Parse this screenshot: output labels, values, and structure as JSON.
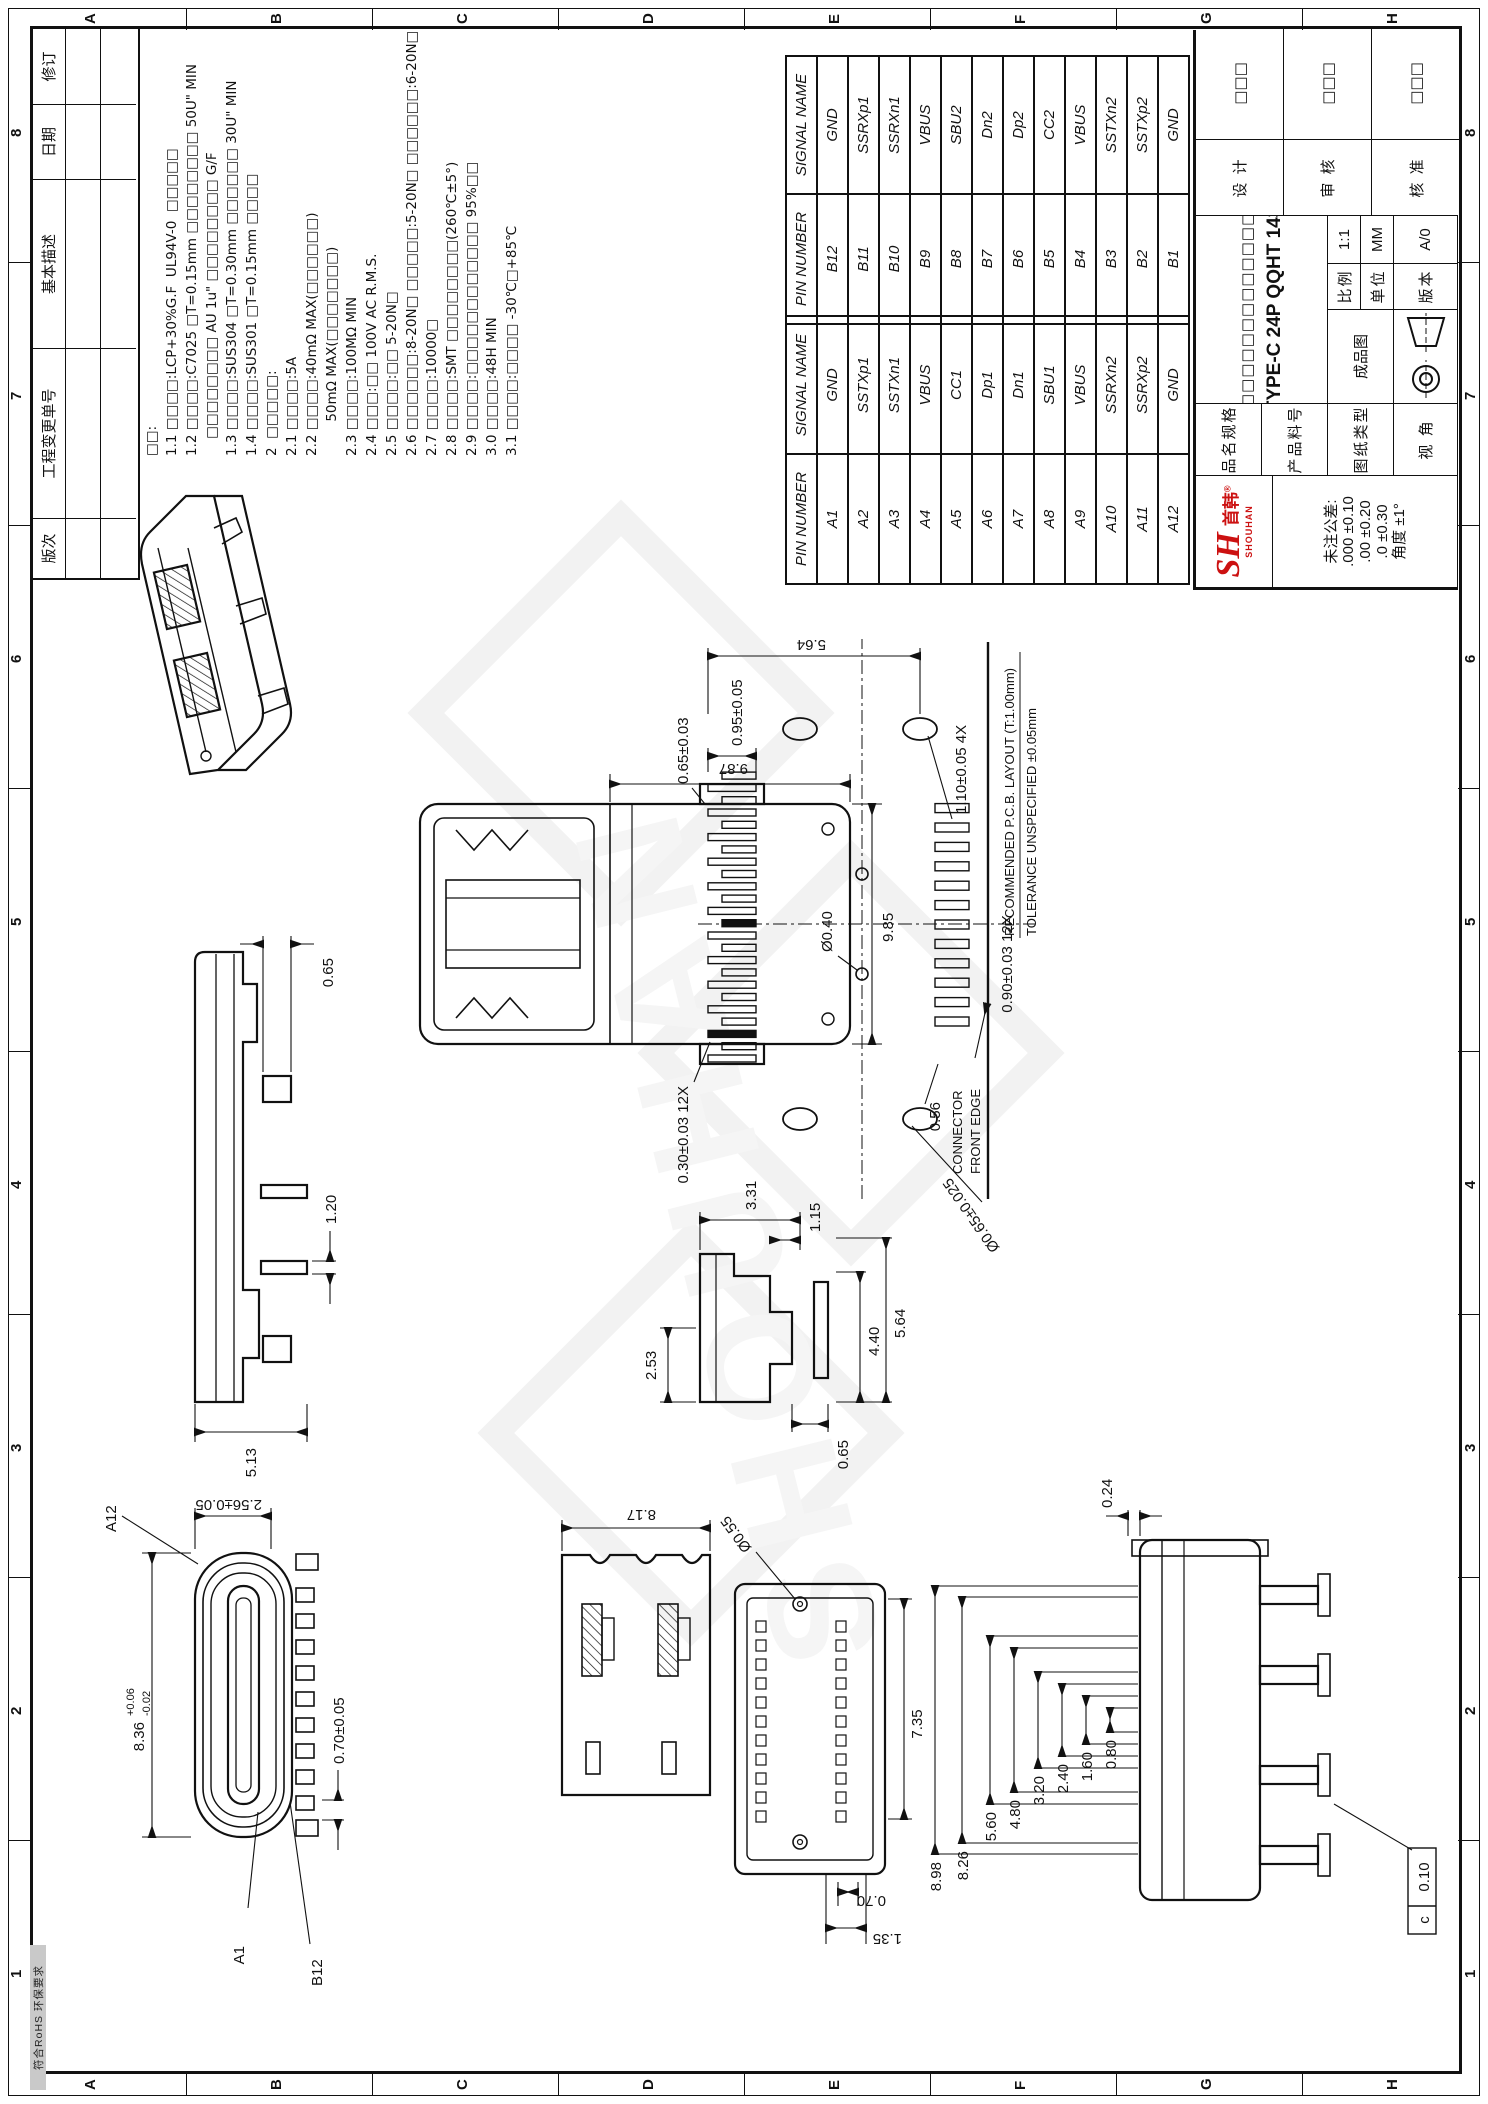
{
  "sheet": {
    "zone_numbers": [
      "1",
      "2",
      "3",
      "4",
      "5",
      "6",
      "7",
      "8"
    ],
    "zone_letters": [
      "A",
      "B",
      "C",
      "D",
      "E",
      "F",
      "G",
      "H"
    ],
    "stamp": "符合RoHS 环保要求",
    "line_color": "#111111",
    "logo_color": "#cc1111"
  },
  "revision_table": {
    "headers": [
      "版次",
      "工程变更单号",
      "基本描述",
      "日期",
      "修订"
    ]
  },
  "notes": {
    "lines": [
      "□□:",
      "1.1 □□□□:LCP+30%G.F  UL94V-0  □□□□□",
      "1.2 □□□□:C7025 □T=0.15mm □□□□□□□□ 50U\" MIN",
      "    □□□□□□□□ AU 1u\" □□□□□□□□ G/F",
      "1.3 □□□□:SUS304 □T=0.30mm □□□□□□ 30U\" MIN",
      "1.4 □□□□:SUS301 □T=0.15mm □□□□",
      "2  □□□□□:",
      "2.1 □□□□:5A",
      "2.2 □□□□:40mΩ MAX(□□□□□□)",
      "        50mΩ MAX(□□□□□□□)",
      "2.3 □□□□:100MΩ MIN",
      "2.4 □□□:□□ 100V AC R.M.S.",
      "2.5 □□□□:□□ 5-20N□",
      "2.6 □□□□□□:8-20N□ □□□□□:5-20N□ □□□□□□:6-20N□",
      "2.7 □□□□:10000□",
      "2.8 □□□□:SMT □□□□□□□□(260℃±5°)",
      "2.9 □□□□:□□□□□□□□□□□□ 95%□□",
      "3.0 □□□□:48H MIN",
      "3.1 □□□□:□□□□ -30℃□+85℃"
    ]
  },
  "pin_tables": {
    "headers": [
      "PIN NUMBER",
      "SIGNAL NAME"
    ],
    "a_rows": [
      [
        "A1",
        "GND"
      ],
      [
        "A2",
        "SSTXp1"
      ],
      [
        "A3",
        "SSTXn1"
      ],
      [
        "A4",
        "VBUS"
      ],
      [
        "A5",
        "CC1"
      ],
      [
        "A6",
        "Dp1"
      ],
      [
        "A7",
        "Dn1"
      ],
      [
        "A8",
        "SBU1"
      ],
      [
        "A9",
        "VBUS"
      ],
      [
        "A10",
        "SSRXn2"
      ],
      [
        "A11",
        "SSRXp2"
      ],
      [
        "A12",
        "GND"
      ]
    ],
    "b_rows": [
      [
        "B12",
        "GND"
      ],
      [
        "B11",
        "SSRXp1"
      ],
      [
        "B10",
        "SSRXn1"
      ],
      [
        "B9",
        "VBUS"
      ],
      [
        "B8",
        "SBU2"
      ],
      [
        "B7",
        "Dn2"
      ],
      [
        "B6",
        "Dp2"
      ],
      [
        "B5",
        "CC2"
      ],
      [
        "B4",
        "VBUS"
      ],
      [
        "B3",
        "SSTXn2"
      ],
      [
        "B2",
        "SSTXp2"
      ],
      [
        "B1",
        "GND"
      ]
    ]
  },
  "title_block": {
    "logo_cn": "首韩",
    "logo_reg": "®",
    "logo_en": "SHOUHAN",
    "logo_mark": "SH",
    "tol_title": "未注公差:",
    "tol_1": ".000  ±0.10",
    "tol_2": ".00   ±0.20",
    "tol_3": ".0    ±0.30",
    "tol_4": "角度   ±1°",
    "label_1": "品名规格",
    "label_2": "产品料号",
    "label_3": "图纸类型",
    "label_4": "视 角",
    "company": "□□□□□□□□□□□□□",
    "product": "TYPE-C 24P QQHT 143",
    "doc_type": "成品图",
    "scale_label": "比例",
    "scale_value": "1:1",
    "unit_label": "单位",
    "unit_value": "MM",
    "version_label": "版本",
    "version_value": "A/0",
    "sign_rows": [
      {
        "label": "设 计",
        "value": "□□□"
      },
      {
        "label": "审 核",
        "value": "□□□"
      },
      {
        "label": "核 准",
        "value": "□□□"
      }
    ]
  },
  "views": {
    "side": {
      "dims": [
        "5.13",
        "1.20",
        "0.65"
      ]
    },
    "top": {
      "dims": [
        "9.87",
        "9.85"
      ]
    },
    "profile": {
      "dims": [
        "2.53",
        "3.31",
        "1.15",
        "0.65",
        "4.40",
        "5.64"
      ]
    },
    "front": {
      "dims": [
        "8.36",
        "+0.06",
        "-0.02",
        "2.56±0.05",
        "0.70±0.05"
      ],
      "labels": [
        "A12",
        "A1",
        "B12"
      ]
    },
    "clips": {
      "dims": [
        "8.17"
      ]
    },
    "bottom": {
      "dims": [
        "7.35",
        "Ø0.55",
        "0.70",
        "1.35"
      ]
    },
    "side2": {
      "dims": [
        "0.24",
        "8.98",
        "8.26",
        "5.60",
        "4.80",
        "3.20",
        "2.40",
        "1.60",
        "0.80"
      ],
      "callout_datum": "c",
      "callout_value": "0.10"
    },
    "pcb": {
      "dims": [
        "0.65±0.03",
        "0.30±0.03 12X",
        "0.95±0.05",
        "5.64",
        "0.90±0.03 12X",
        "1.10±0.05 4X",
        "Ø0.65±0.025",
        "Ø0.40",
        "0.56"
      ],
      "title1": "RECOMMENDED  P.C.B. LAYOUT (T:1.00mm)",
      "title2": "TOLERANCE UNSPECIFIED ±0.05mm",
      "front_edge1": "CONNECTOR",
      "front_edge2": "FRONT EDGE"
    }
  },
  "watermark": "SHOUHAN"
}
